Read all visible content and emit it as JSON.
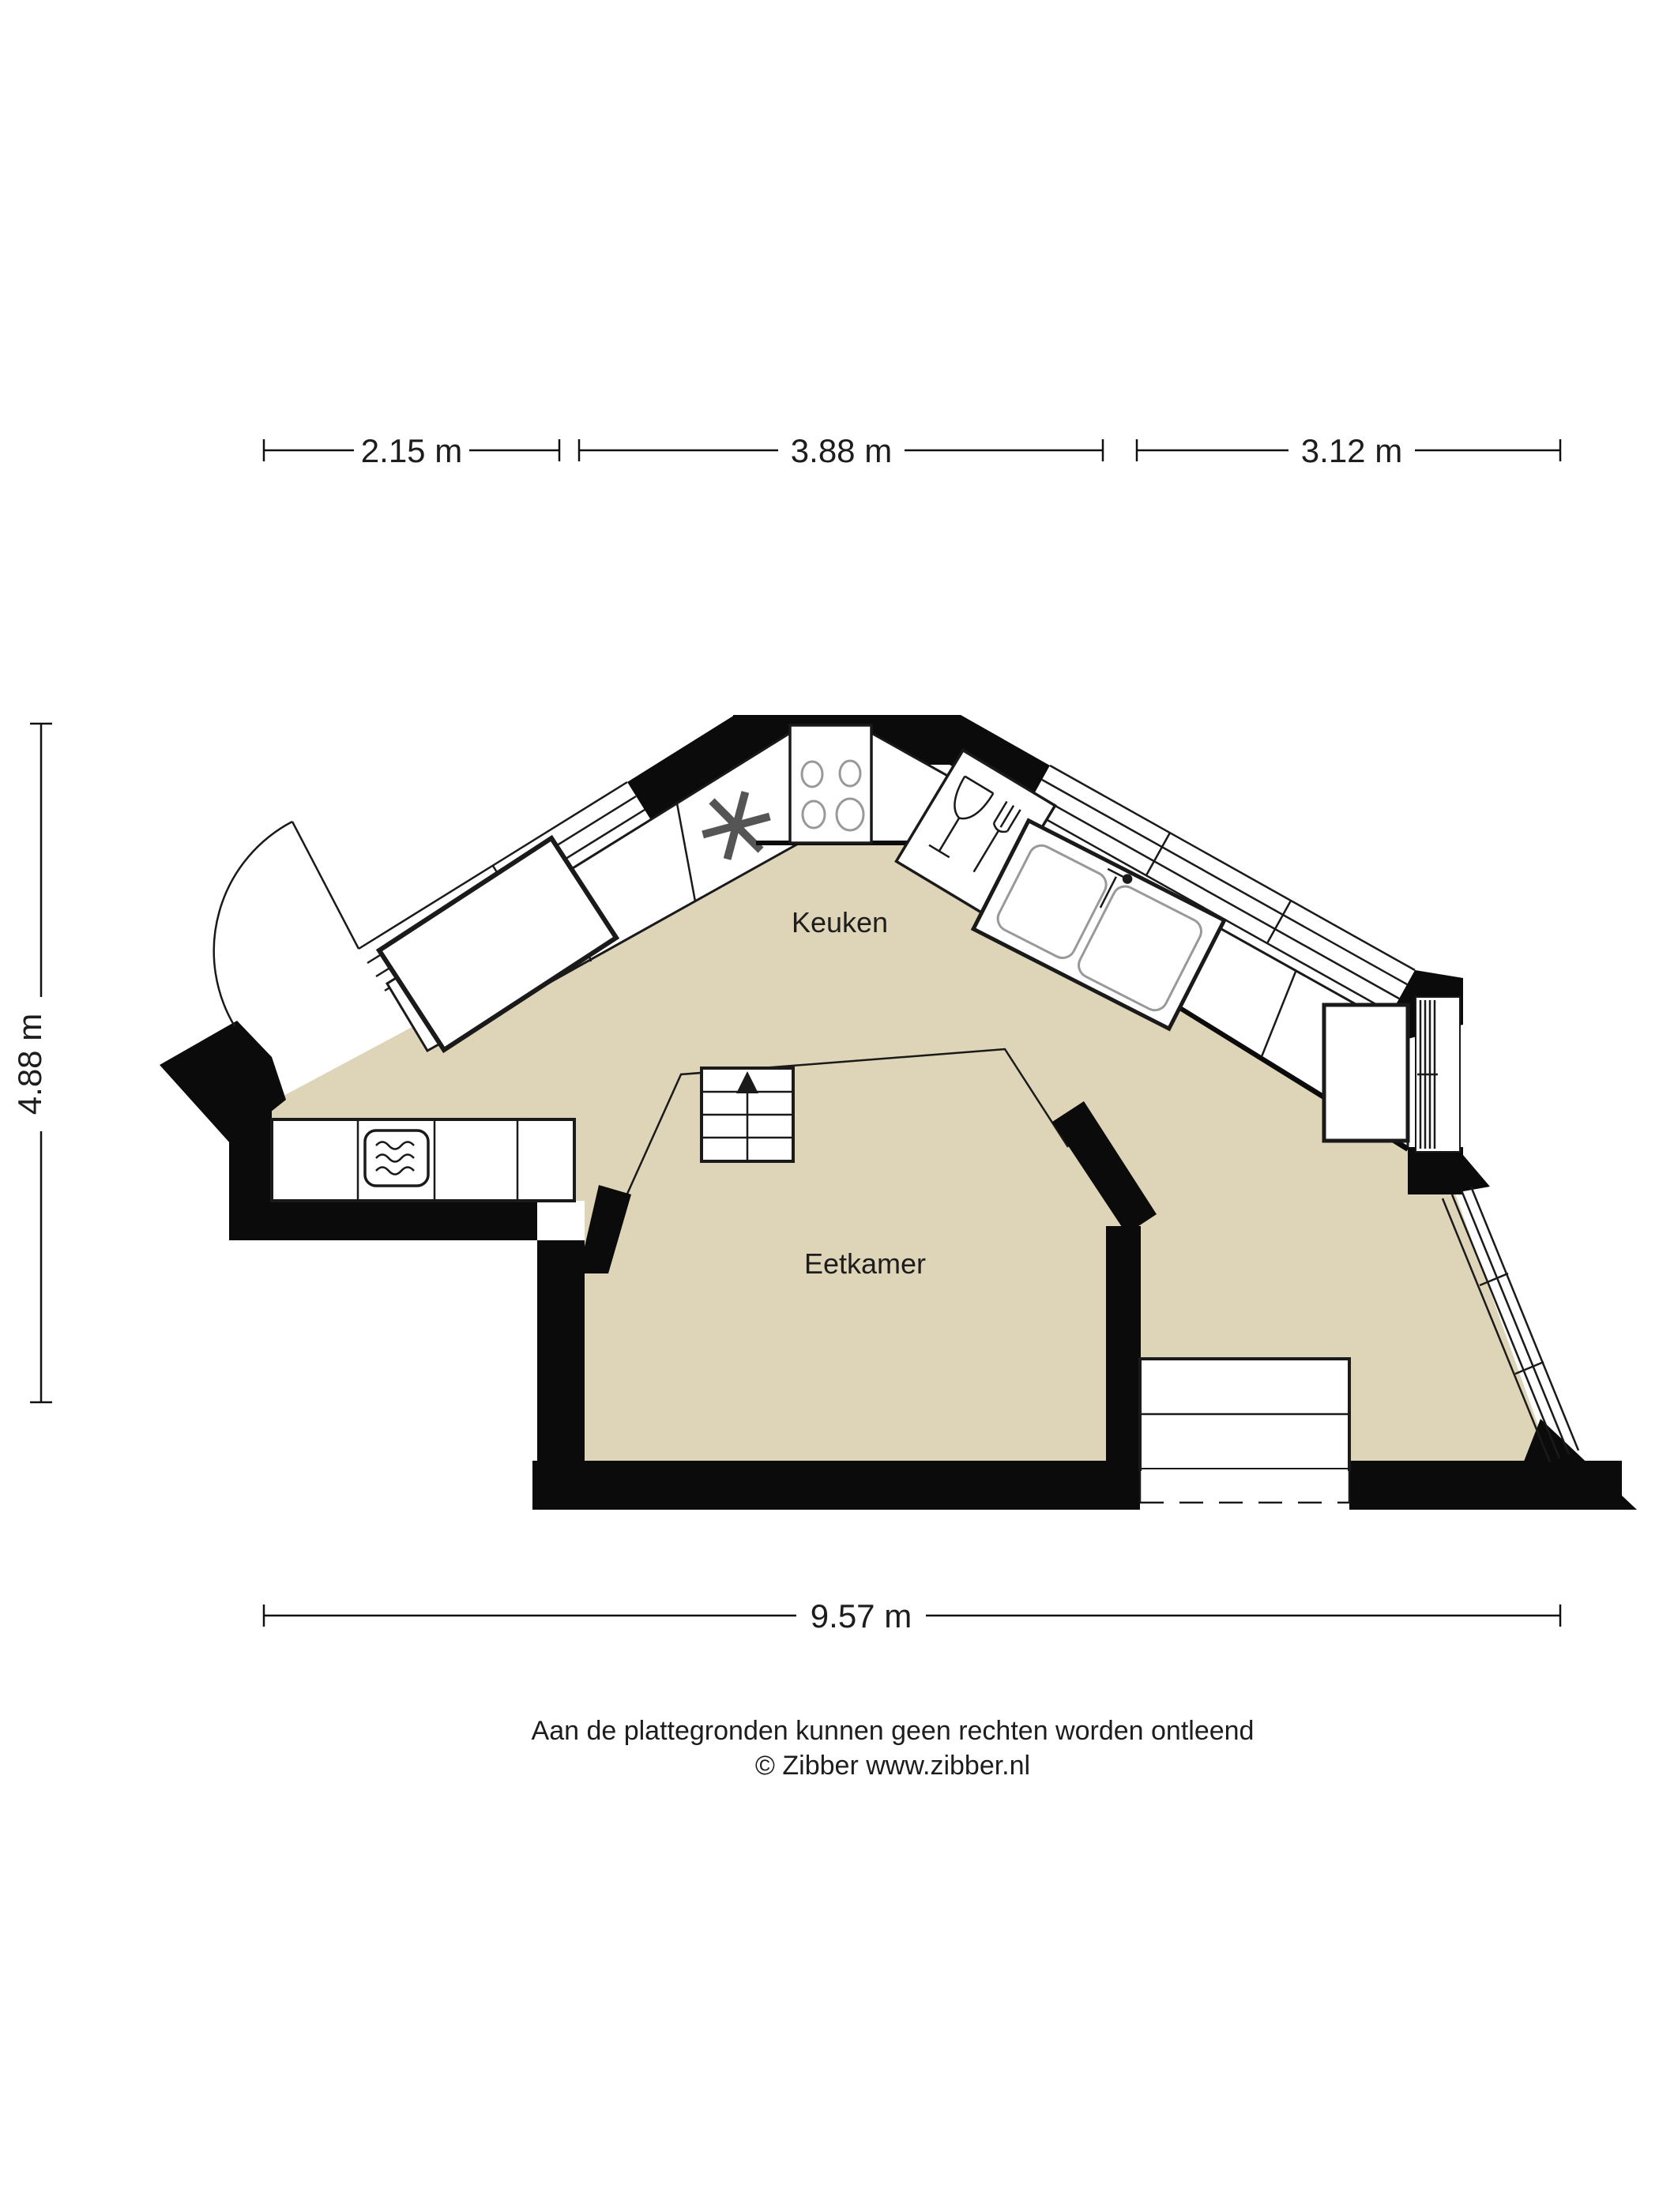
{
  "meta": {
    "type": "floorplan",
    "language": "nl"
  },
  "colors": {
    "floor": "#ded5b8",
    "wall": "#0b0b0b",
    "line": "#1a1a1a",
    "text": "#1d1d1d",
    "background": "#ffffff"
  },
  "rooms": [
    {
      "id": "keuken",
      "label": "Keuken"
    },
    {
      "id": "eetkamer",
      "label": "Eetkamer"
    }
  ],
  "dimensions": {
    "top": [
      {
        "label": "2.15 m"
      },
      {
        "label": "3.88 m"
      },
      {
        "label": "3.12 m"
      }
    ],
    "left": {
      "label": "4.88 m"
    },
    "bottom": {
      "label": "9.57 m"
    }
  },
  "fixtures": [
    "entry-door",
    "window-upper-left",
    "window-upper-right",
    "window-right",
    "window-lower-right",
    "fridge-snowflake",
    "stove-4-burners",
    "dishwasher",
    "double-sink",
    "tall-cabinet",
    "microwave-counter",
    "stairs-up",
    "door-step"
  ],
  "footer": {
    "line1": "Aan de plattegronden kunnen geen rechten worden ontleend",
    "line2": "© Zibber www.zibber.nl"
  }
}
